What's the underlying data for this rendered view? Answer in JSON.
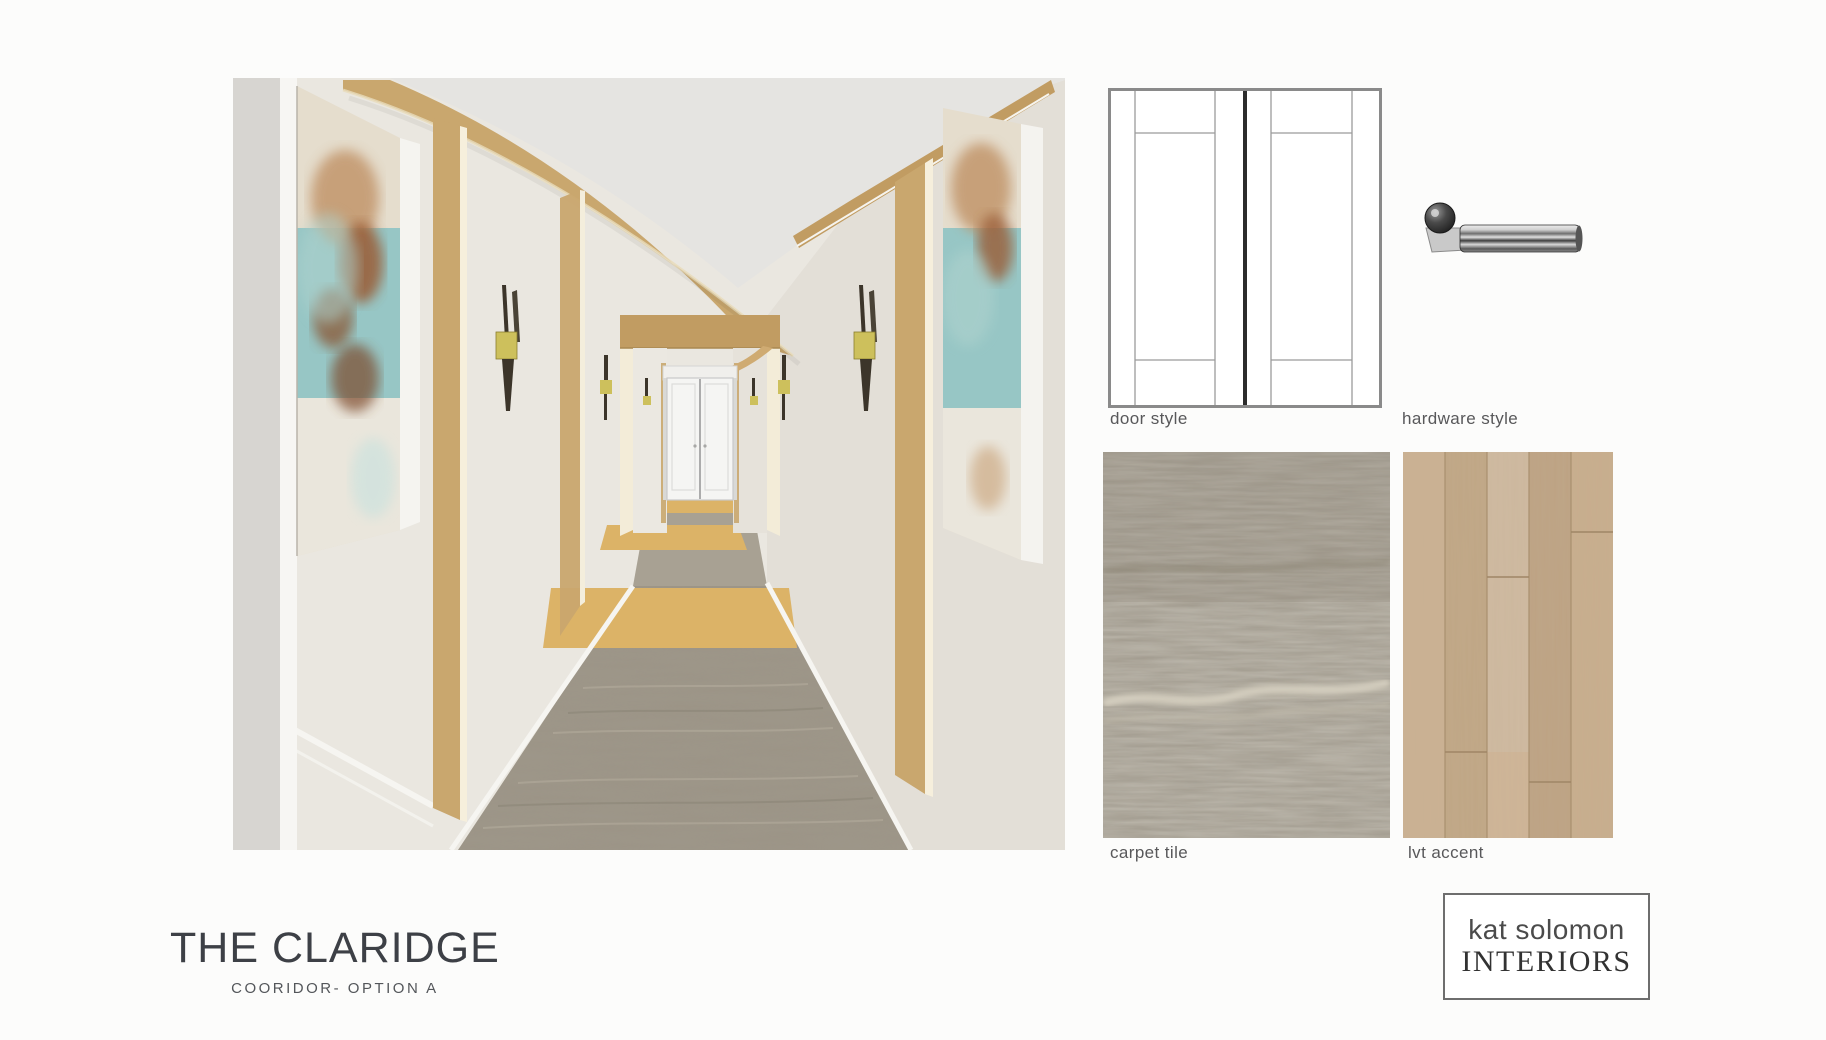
{
  "board": {
    "title_block": {
      "title": "THE CLARIDGE",
      "subtitle": "COORIDOR- OPTION A"
    },
    "figures": {
      "door_style": {
        "label": "door style"
      },
      "hardware": {
        "label": "hardware style"
      },
      "carpet": {
        "label": "carpet tile"
      },
      "lvt": {
        "label": "lvt accent"
      }
    },
    "logo": {
      "line1": "kat solomon",
      "line2": "INTERIORS"
    },
    "colors": {
      "background": "#fcfcfb",
      "wood": "#c9a76e",
      "wood_dark": "#c19c62",
      "wood_floor": "#dcb367",
      "carpet": "#9c9486",
      "carpet_sample": "#9d9689",
      "lvt": "#c6ab8b",
      "wall": "#eae7e0",
      "wall_right": "#e3dfd7",
      "ceiling": "#e5e4e1",
      "near_wall_gray": "#d7d5d1",
      "trim_white": "#f6f5f1",
      "portal_cream": "#f3ecd8",
      "artwork_teal": "#97c6c5",
      "artwork_rust": "#9a5c36",
      "artwork_cream": "#e5ddcd",
      "sconce_bronze": "#3c352a",
      "sconce_gold": "#cdc05c",
      "door_white": "#f5f5f3",
      "diagram_border": "#8a8a8a",
      "diagram_center_line": "#2c2c2c",
      "diagram_inner_line": "#9b9b9b",
      "text": "#3d4046"
    }
  }
}
